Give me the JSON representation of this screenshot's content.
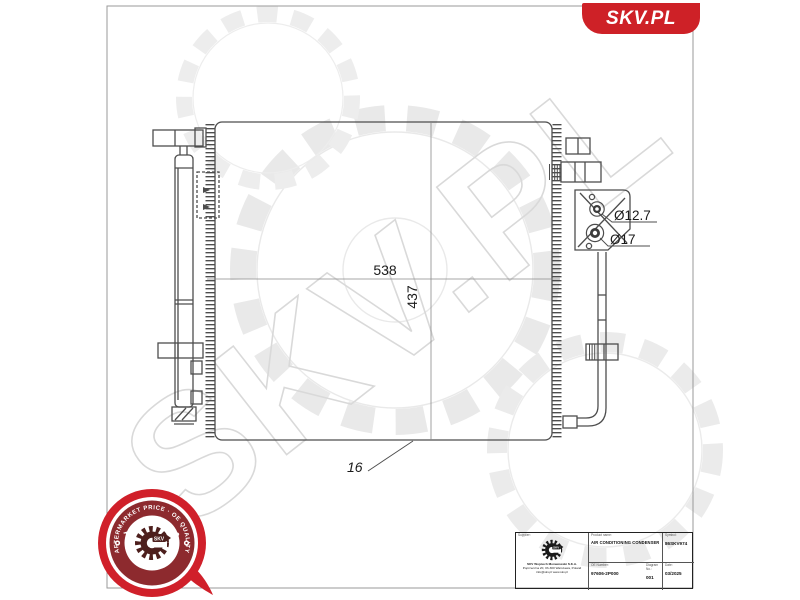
{
  "header": {
    "badge_text": "SKV.PL"
  },
  "watermark": {
    "text": "SKV.PL"
  },
  "drawing": {
    "overall_width_mm": "538",
    "overall_height_mm": "437",
    "top_port_diameter": "Ø12.7",
    "bottom_port_diameter": "Ø17",
    "core_depth_mm": "16"
  },
  "stamp": {
    "top_arc": "AFTERMARKET PRICE · OE QUALITY",
    "bottom_arc": "AUTO PARTS",
    "center_text": "SKV"
  },
  "title_block": {
    "supplier_label": "Supplier:",
    "company_name": "SKV Wojciech Morawowski S.K.A.",
    "company_address": "Poprzeczna 20, 03-300 Warszawa, Poland",
    "company_contact": "info@skv.pl  www.skv.pl",
    "product_name_label": "Product name:",
    "product_name": "AIR CONDITIONING CONDENSER",
    "symbol_label": "Symbol:",
    "symbol": "86SKV974",
    "oe_number_label": "OE Number:",
    "oe_number": "97606-2P000",
    "diagram_no_label": "Diagram No.:",
    "diagram_no": "001",
    "date_label": "Date:",
    "date": "03/2025"
  },
  "colors": {
    "brand_red": "#ce2127",
    "stamp_maroon": "#8d2a2e",
    "drawing_line": "#4d4d4d",
    "watermark_gray": "#dcdcdc"
  }
}
